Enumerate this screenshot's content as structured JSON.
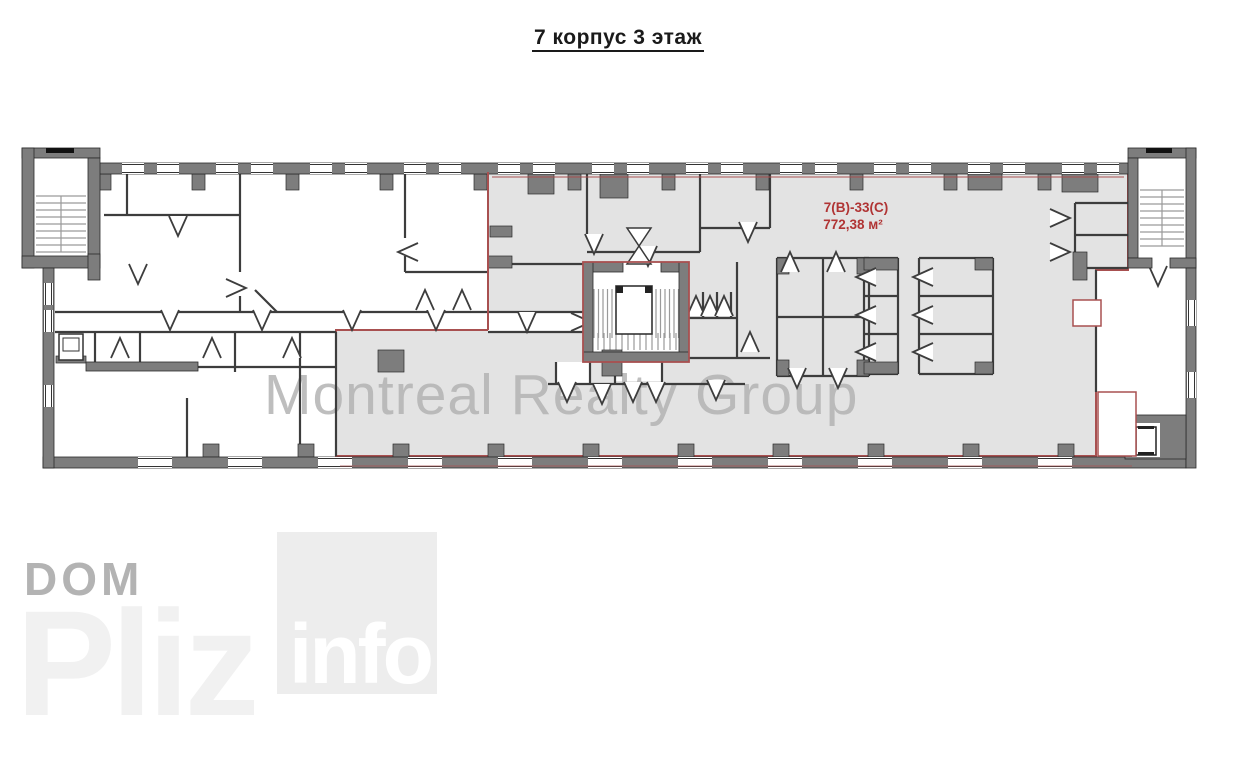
{
  "title": {
    "text": "7 корпус 3 этаж"
  },
  "floor_plan": {
    "unit": {
      "code": "7(В)-33(С)",
      "area": "772,38 м²"
    },
    "colors": {
      "wall_gray": "#7d7d7d",
      "unit_fill": "#e3e3e3",
      "unit_outline": "#a85050",
      "unit_label_red": "#b03434",
      "thin_wall": "#3d3d3d"
    }
  },
  "watermark": {
    "text": "Montreal Realty Group",
    "color": "#b3b3b3"
  },
  "logo": {
    "word1": "DOM",
    "word2": "Pliz",
    "badge": "info"
  }
}
